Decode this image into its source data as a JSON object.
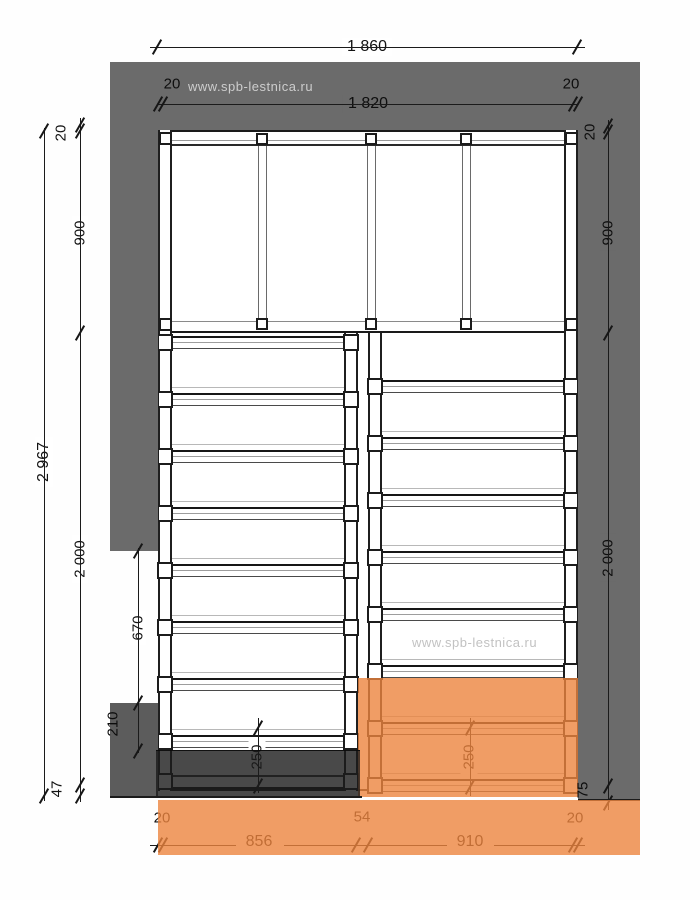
{
  "watermark": {
    "top": "www.spb-lestnica.ru",
    "middle": "www.spb-lestnica.ru"
  },
  "dimensions": {
    "top_total": "1 860",
    "top_inner": "1 820",
    "top_left_offset": "20",
    "top_right_offset": "20",
    "left_total": "2 967",
    "left_top_offset": "20",
    "left_landing": "900",
    "left_flight": "2 000",
    "left_bottom": "47",
    "left_run": "670",
    "left_block": "210",
    "right_top_offset": "20",
    "right_landing": "900",
    "right_flight": "2 000",
    "right_bottom": "75",
    "bottom_left_offset": "20",
    "bottom_left_flight": "856",
    "bottom_gap": "54",
    "bottom_right_flight": "910",
    "bottom_right_offset": "20",
    "tread_left": "250",
    "tread_right": "250"
  },
  "colors": {
    "wall": "#6b6b6b",
    "wall_block": "#5c5c5c",
    "highlight_orange": "rgba(236,132,62,0.80)",
    "highlight_dark": "rgba(28,28,28,0.80)",
    "line": "#1b1b1b"
  },
  "plan": {
    "type": "u_turn_staircase_top_view",
    "landing": {
      "joists_x": [
        258,
        367,
        462
      ],
      "top": 130,
      "bottom": 333
    },
    "flights": [
      {
        "name": "left",
        "x": 172,
        "width": 172,
        "first_tread_y": 336,
        "pitch": 57,
        "treads": 8,
        "rim_y": 775,
        "stringer_left": 158,
        "stringer_right": 344
      },
      {
        "name": "right",
        "x": 382,
        "width": 182,
        "first_tread_y": 380,
        "pitch": 57,
        "treads": 8,
        "rim_y": null,
        "stringer_left": 368,
        "stringer_right": 564
      }
    ],
    "tread_depth_mm": "250"
  }
}
